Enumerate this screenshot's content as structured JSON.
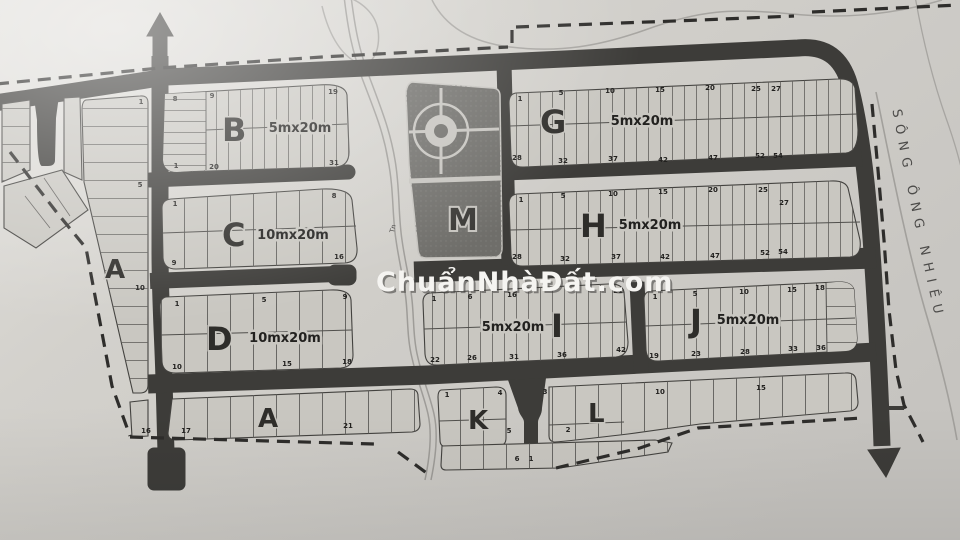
{
  "map": {
    "watermark": "ChuẩnNhàĐất.com",
    "river_label": "SÔNG ÔNG NHIÊU",
    "stream_label": "Tn",
    "blocks": {
      "a": {
        "label": "A",
        "numbers": [
          "1",
          "5",
          "10"
        ]
      },
      "a_row": {
        "label": "A",
        "numbers": [
          "16",
          "17",
          "21"
        ]
      },
      "b": {
        "label": "B",
        "size": "5mx20m",
        "top": [
          "8",
          "9",
          "19"
        ],
        "bottom": [
          "1",
          "20",
          "31"
        ]
      },
      "c": {
        "label": "C",
        "size": "10mx20m",
        "top": [
          "1",
          "8"
        ],
        "bottom": [
          "9",
          "16"
        ]
      },
      "d": {
        "label": "D",
        "size": "10mx20m",
        "top": [
          "1",
          "5",
          "9"
        ],
        "bottom": [
          "10",
          "15",
          "18"
        ]
      },
      "g": {
        "label": "G",
        "size": "5mx20m",
        "top": [
          "1",
          "5",
          "10",
          "15",
          "20",
          "25",
          "27"
        ],
        "bottom": [
          "28",
          "32",
          "37",
          "42",
          "47",
          "52",
          "54"
        ]
      },
      "h": {
        "label": "H",
        "size": "5mx20m",
        "top": [
          "1",
          "5",
          "10",
          "15",
          "20",
          "25",
          "27"
        ],
        "bottom": [
          "28",
          "32",
          "37",
          "42",
          "47",
          "52",
          "54"
        ]
      },
      "i": {
        "label": "I",
        "size": "5mx20m",
        "top": [
          "1",
          "6",
          "16",
          "21"
        ],
        "bottom": [
          "22",
          "26",
          "31",
          "36",
          "42"
        ]
      },
      "j": {
        "label": "J",
        "size": "5mx20m",
        "top": [
          "1",
          "5",
          "10",
          "15",
          "18"
        ],
        "bottom": [
          "19",
          "23",
          "28",
          "33",
          "36"
        ]
      },
      "k": {
        "label": "K",
        "numbers": [
          "1",
          "4",
          "5"
        ]
      },
      "l": {
        "label": "L",
        "numbers": [
          "3",
          "2",
          "10",
          "15"
        ]
      },
      "kl_row": {
        "numbers": [
          "6",
          "1"
        ]
      },
      "m": {
        "label": "M"
      }
    },
    "colors": {
      "paper": "#d3d1cc",
      "block_fill": "#c9c7c1",
      "road": "#3d3c39",
      "m_block": "#6f6e6a",
      "watermark_fill": "#f5f4f1"
    }
  }
}
